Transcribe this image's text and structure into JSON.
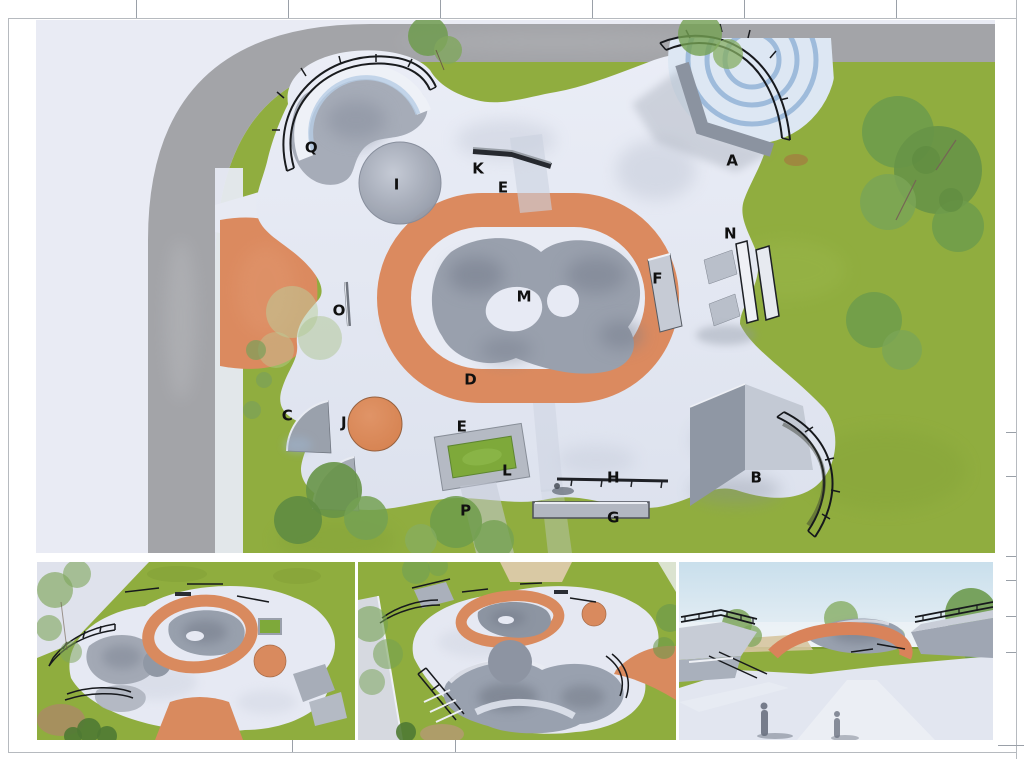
{
  "sheet": {
    "border_color": "#b6babf",
    "tick_color": "#9aa0a8"
  },
  "plan": {
    "labels": [
      {
        "id": "Q",
        "x": 28.7,
        "y": 24.0
      },
      {
        "id": "I",
        "x": 37.6,
        "y": 31.0
      },
      {
        "id": "K",
        "x": 46.1,
        "y": 28.0
      },
      {
        "id": "E",
        "x": 48.7,
        "y": 31.5
      },
      {
        "id": "A",
        "x": 72.6,
        "y": 26.5
      },
      {
        "id": "N",
        "x": 72.4,
        "y": 40.2
      },
      {
        "id": "F",
        "x": 64.8,
        "y": 48.6
      },
      {
        "id": "M",
        "x": 50.9,
        "y": 52.0
      },
      {
        "id": "O",
        "x": 31.6,
        "y": 54.6
      },
      {
        "id": "D",
        "x": 45.3,
        "y": 67.5
      },
      {
        "id": "C",
        "x": 26.2,
        "y": 74.3
      },
      {
        "id": "J",
        "x": 32.1,
        "y": 75.6
      },
      {
        "id": "E",
        "x": 44.4,
        "y": 76.4
      },
      {
        "id": "L",
        "x": 49.1,
        "y": 84.6
      },
      {
        "id": "P",
        "x": 44.8,
        "y": 92.1
      },
      {
        "id": "H",
        "x": 60.2,
        "y": 85.9
      },
      {
        "id": "G",
        "x": 60.2,
        "y": 93.4
      },
      {
        "id": "B",
        "x": 75.1,
        "y": 85.9
      }
    ],
    "colors": {
      "label": "#101010",
      "grass": "#90ad3f",
      "road": "#a3a4a8",
      "pale_ground": "#e9ebf4",
      "paving": "#e5e8f2",
      "accent_orange": "#db8a5f",
      "bowl_gray": "#9aa1ae",
      "railing": "#1a1a1a",
      "planter_green": "#7ea93a"
    }
  }
}
